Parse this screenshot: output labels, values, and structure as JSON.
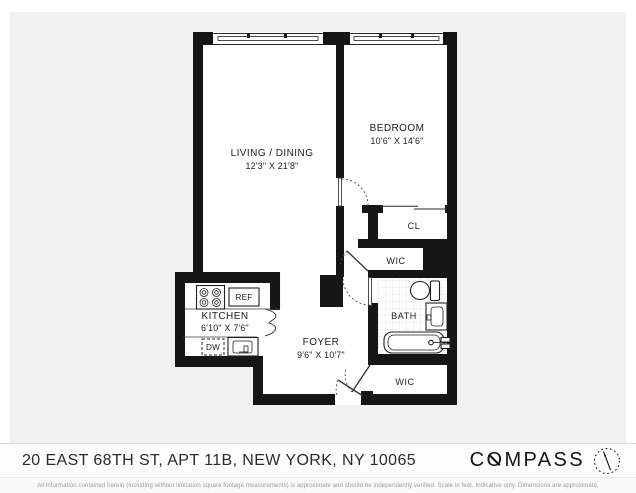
{
  "floor_plan": {
    "rooms": {
      "living": {
        "name": "LIVING / DINING",
        "dims": "12'3\" X 21'8\""
      },
      "bedroom": {
        "name": "BEDROOM",
        "dims": "10'6\" X 14'6\""
      },
      "kitchen": {
        "name": "KITCHEN",
        "dims": "6'10\" X 7'6\""
      },
      "foyer": {
        "name": "FOYER",
        "dims": "9'6\" X 10'7\""
      },
      "bath": {
        "name": "BATH"
      },
      "closet": {
        "name": "CL"
      },
      "wic_upper": {
        "name": "WIC"
      },
      "wic_lower": {
        "name": "WIC"
      }
    },
    "fixtures": {
      "refrigerator": "REF",
      "dishwasher": "DW"
    }
  },
  "footer": {
    "address": "20 EAST 68TH ST, APT 11B, NEW YORK, NY 10065",
    "brand": {
      "prefix": "C",
      "o": "O",
      "suffix": "MPASS"
    },
    "disclaimer": "All information contained herein (including without limitation square footage measurements) is approximate and should be independently verified. Scale in feet. Indicative only. Dimensions are approximate."
  },
  "colors": {
    "wall": "#161616",
    "plan_background": "#f1f1f1",
    "paper": "#ffffff"
  }
}
